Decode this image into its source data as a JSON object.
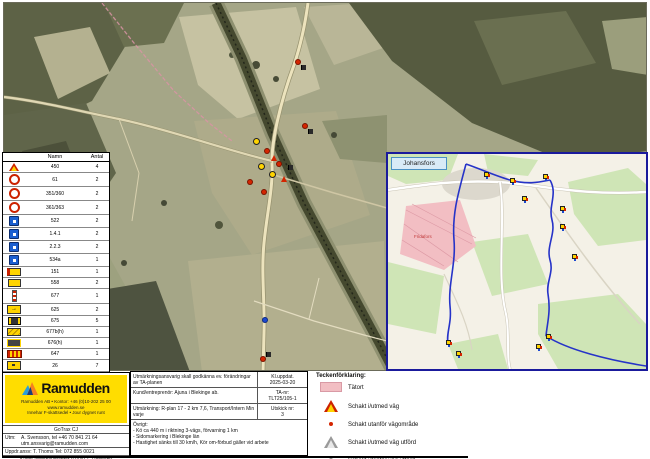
{
  "colors": {
    "ramudden_yellow": "#FFDD00",
    "route_blue": "#2633C8",
    "tatort_pink": "#F2BEC3",
    "inset_border": "#1A1A9C",
    "sign_red": "#CC2200",
    "sign_yellow": "#FFD400"
  },
  "legend_table": {
    "name_header": "Namn",
    "count_header": "Antal",
    "rows": [
      {
        "icon": "warn-triangle",
        "name": "450",
        "count": "4"
      },
      {
        "icon": "prohibition-ring",
        "name": "61",
        "count": "2"
      },
      {
        "icon": "prohibition-ring",
        "name": "351/360",
        "count": "2"
      },
      {
        "icon": "prohibition-ring",
        "name": "361/363",
        "count": "2"
      },
      {
        "icon": "blue-square",
        "name": "522",
        "count": "2"
      },
      {
        "icon": "blue-square",
        "name": "1.4.1",
        "count": "2"
      },
      {
        "icon": "blue-square",
        "name": "2.2.3",
        "count": "2"
      },
      {
        "icon": "blue-square",
        "name": "534a",
        "count": "1"
      },
      {
        "icon": "yellow-red-plate",
        "name": "151",
        "count": "1"
      },
      {
        "icon": "yellow-rect",
        "name": "558",
        "count": "2"
      },
      {
        "icon": "marker-post",
        "name": "677",
        "count": "1"
      },
      {
        "icon": "yellow-arrow",
        "name": "625",
        "count": "2"
      },
      {
        "icon": "dark-plate",
        "name": "675",
        "count": "5"
      },
      {
        "icon": "yellow-barrier",
        "name": "677b(h)",
        "count": "1"
      },
      {
        "icon": "dark-barrier",
        "name": "676(h)",
        "count": "1"
      },
      {
        "icon": "striped-barrier",
        "name": "647",
        "count": "1"
      },
      {
        "icon": "yellow-plate",
        "name": "26",
        "count": "7"
      },
      {
        "icon": "yellow-plate",
        "name": "611",
        "count": "1"
      },
      {
        "icon": "yellow-plate",
        "name": "614",
        "count": "3"
      },
      {
        "icon": "vms-trailer",
        "name": "Ledtavla/vmtxt Utfällt kör",
        "count": "1"
      },
      {
        "icon": "cone",
        "name": "Kon 1,8m",
        "count": "23"
      },
      {
        "icon": "blue-marker",
        "name": "Markör",
        "count": "1"
      },
      {
        "icon": "person",
        "name": "Personal ute",
        "count": "3"
      }
    ]
  },
  "map": {
    "markers": [
      {
        "t": "cone",
        "x": 292,
        "y": 57
      },
      {
        "t": "flag",
        "x": 297,
        "y": 62
      },
      {
        "t": "cone",
        "x": 299,
        "y": 121
      },
      {
        "t": "flag",
        "x": 304,
        "y": 126
      },
      {
        "t": "sign-y",
        "x": 249,
        "y": 135
      },
      {
        "t": "cone",
        "x": 261,
        "y": 146
      },
      {
        "t": "sign-r",
        "x": 267,
        "y": 152
      },
      {
        "t": "sign-y",
        "x": 254,
        "y": 160
      },
      {
        "t": "cone",
        "x": 273,
        "y": 159
      },
      {
        "t": "sign-y",
        "x": 265,
        "y": 168
      },
      {
        "t": "sign-r",
        "x": 277,
        "y": 173
      },
      {
        "t": "cone",
        "x": 244,
        "y": 177
      },
      {
        "t": "flag",
        "x": 284,
        "y": 162
      },
      {
        "t": "cone",
        "x": 258,
        "y": 187
      },
      {
        "t": "blue",
        "x": 259,
        "y": 315
      },
      {
        "t": "flag",
        "x": 262,
        "y": 349
      },
      {
        "t": "cone",
        "x": 257,
        "y": 354
      }
    ]
  },
  "inset": {
    "place_label": "Johansfors",
    "area_label": "Fridafors",
    "clusters": [
      {
        "x": 96,
        "y": 18
      },
      {
        "x": 122,
        "y": 24
      },
      {
        "x": 155,
        "y": 20
      },
      {
        "x": 134,
        "y": 42
      },
      {
        "x": 172,
        "y": 52
      },
      {
        "x": 172,
        "y": 70
      },
      {
        "x": 184,
        "y": 100
      },
      {
        "x": 158,
        "y": 180
      },
      {
        "x": 148,
        "y": 190
      },
      {
        "x": 58,
        "y": 186
      },
      {
        "x": 68,
        "y": 197
      }
    ]
  },
  "right_legend": {
    "title": "Teckenförklaring:",
    "items": [
      {
        "icon": "tatort-swatch",
        "label": "Tätort"
      },
      {
        "icon": "active-dig-triangle",
        "label": "Schakt i/utmed väg"
      },
      {
        "icon": "active-dig-dot",
        "label": "Schakt utanför vägområde"
      },
      {
        "icon": "done-dig-triangle",
        "label": "Schakt i/utmed väg utförd"
      },
      {
        "icon": "done-dig-dot",
        "label": "Schakt utanför väg utförd"
      }
    ]
  },
  "info_block": {
    "note": "Utmärkningsansvarig skall godkänna ev. förändringar av TA-planen",
    "updated_label": "Kl.uppdat.",
    "updated_value": "2025-03-20",
    "client": "Kund/entreprenör: Ajuna i Blekinge ab.",
    "ta_label": "TA-nr:",
    "ta_value": "TLT25/105-1",
    "location": "Utmärkning: R-plan 17 - 2 km 7,6, Transport/Intern Min varje",
    "issue_label": "Utskick nr:",
    "issue_value": "3",
    "other_label": "Övrigt:",
    "bullets": [
      "- Kö ca 440 m i riktning 3-vägs, förvarning 1 km",
      "- Sidomarkering i Blekinge län",
      "- Hastighet sänks till 30 km/h, Kör om-förbud gäller vid arbete"
    ]
  },
  "ramudden": {
    "brand": "Ramudden",
    "addr": [
      "Ramudden AB • Kontor: +46 (0)10-202 25 00",
      "www.ramudden.se",
      "Innehar F-skattsedel • Jour dygnet runt"
    ],
    "gotrax": "GoTrax CJ",
    "utm_label": "Utm:",
    "utm_line1": "A. Svensson, tel +46 70 841 21 64",
    "utm_line2": "utm.ansvarig@ramudden.com",
    "uppdrag": "Uppdr.ansv: T. Thoms Tel: 072 855 0021",
    "kund": "Kund: underleverantör 92430-1, Ronneby",
    "taplan": "TA-plan ärende nr ELK00025"
  }
}
